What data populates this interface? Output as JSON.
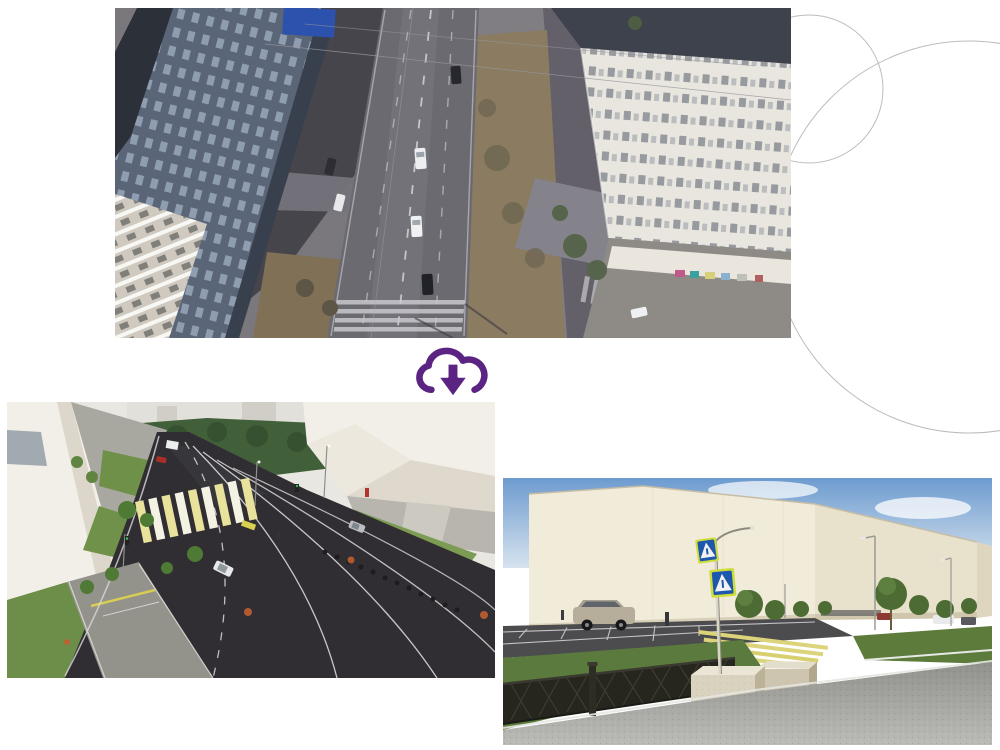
{
  "canvas": {
    "width": 1000,
    "height": 750,
    "background": "#ffffff"
  },
  "decor": {
    "circle_stroke": "#bcbcbc"
  },
  "transition_icon": {
    "kind": "cloud-download",
    "color": "#5b2483"
  },
  "figures": {
    "aerial_before": {
      "kind": "aerial-drone-photo-of-intersection"
    },
    "render_intersection": {
      "kind": "3d-render-redesigned-intersection"
    },
    "render_crossing": {
      "kind": "3d-render-pedestrian-crossing"
    }
  },
  "palette": {
    "asphalt_photo": "#6c6a71",
    "asphalt_render": "#302e32",
    "lawn_green": "#6f9049",
    "crosswalk_yellow": "#e9e29c",
    "building_cream": "#f1ebda",
    "sky_blue": "#6d9bcf",
    "manhole_orange": "#c05f30"
  }
}
